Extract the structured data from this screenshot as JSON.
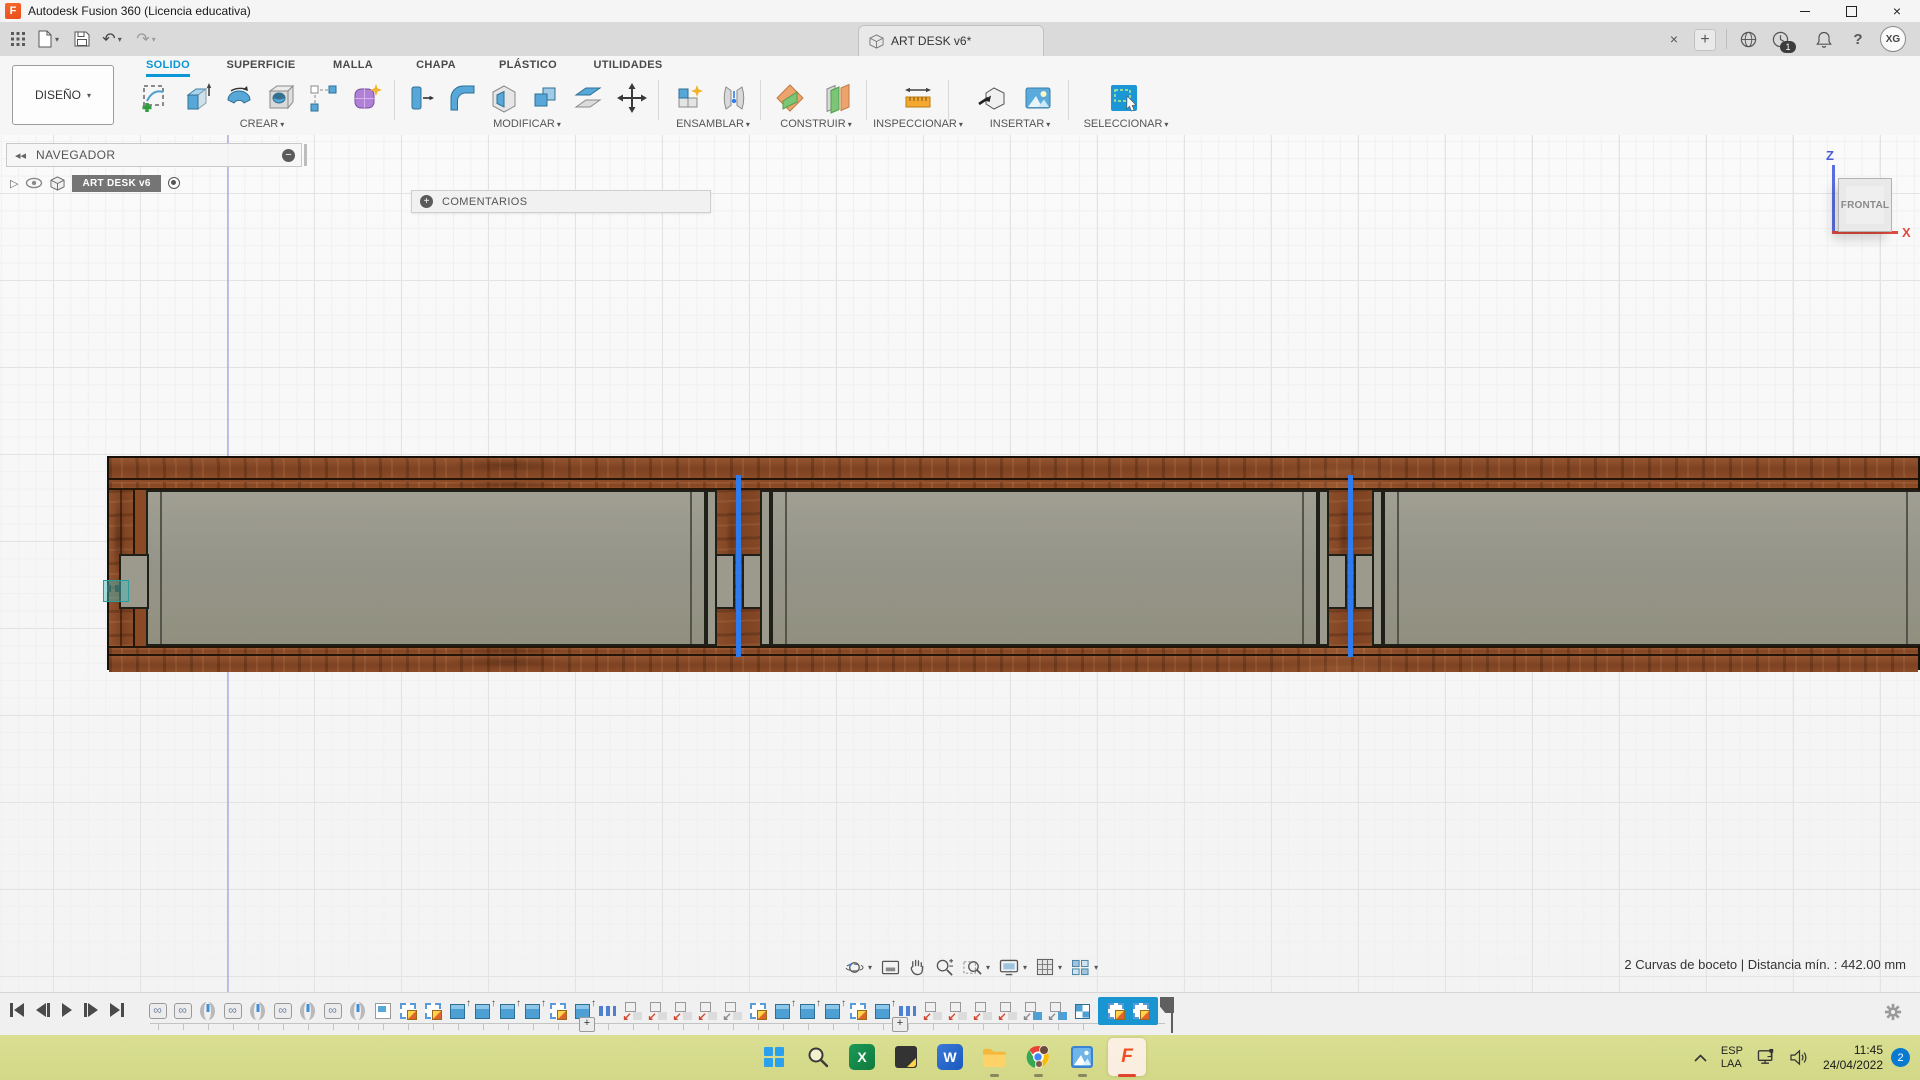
{
  "window": {
    "title": "Autodesk Fusion 360 (Licencia educativa)",
    "app_icon_letter": "F"
  },
  "doc_tab": {
    "label": "ART DESK v6*"
  },
  "top_right": {
    "close_tab": "×",
    "new_tab": "+",
    "jobs_badge": "1",
    "help": "?",
    "avatar": "XG"
  },
  "ribbon": {
    "design_button": "DISEÑO",
    "tabs": [
      {
        "label": "SOLIDO",
        "active": true
      },
      {
        "label": "SUPERFICIE"
      },
      {
        "label": "MALLA"
      },
      {
        "label": "CHAPA"
      },
      {
        "label": "PLÁSTICO"
      },
      {
        "label": "UTILIDADES"
      }
    ],
    "groups": [
      {
        "label": "CREAR"
      },
      {
        "label": "MODIFICAR"
      },
      {
        "label": "ENSAMBLAR"
      },
      {
        "label": "CONSTRUIR"
      },
      {
        "label": "INSPECCIONAR"
      },
      {
        "label": "INSERTAR"
      },
      {
        "label": "SELECCIONAR"
      }
    ]
  },
  "navigator": {
    "header": "NAVEGADOR",
    "item_label": "ART DESK v6"
  },
  "comments": {
    "label": "COMENTARIOS"
  },
  "viewcube": {
    "face": "FRONTAL",
    "axis_z": "Z",
    "axis_x": "X"
  },
  "status": {
    "selection": "2 Curvas de boceto | Distancia mín. : 442.00 mm"
  },
  "navbar_icons": [
    "orbit",
    "look-at",
    "pan",
    "zoom",
    "zoom-window",
    "display-settings",
    "grid-settings",
    "viewports"
  ],
  "timeline": {
    "features": [
      "rigid",
      "rigid",
      "joint",
      "rigid",
      "joint",
      "rigid",
      "joint",
      "rigid",
      "joint",
      "plane",
      "sketch",
      "sketch",
      "extrude",
      "extrude",
      "extrude",
      "extrude",
      "sketch",
      "extrude",
      "pattern",
      "move",
      "move",
      "move",
      "move",
      "movegray",
      "sketch",
      "extrude",
      "extrude",
      "extrude",
      "sketch",
      "extrude",
      "pattern",
      "move",
      "move",
      "move",
      "move",
      "moveblue",
      "moveblue",
      "combine"
    ],
    "selected_features": [
      "sketch",
      "sketch"
    ],
    "group_markers": [
      "+",
      "+"
    ]
  },
  "taskbar": {
    "apps": [
      "start",
      "search",
      "excel",
      "sticky-notes",
      "word",
      "file-explorer",
      "chrome",
      "photos",
      "fusion-360"
    ],
    "app_glyphs": {
      "excel": "X",
      "word": "W",
      "fusion": "F"
    },
    "tray": {
      "lang_top": "ESP",
      "lang_bottom": "LAA",
      "time": "11:45",
      "date": "24/04/2022",
      "notif_badge": "2"
    }
  },
  "colors": {
    "accent_blue": "#0a96d7",
    "selection_blue": "#2e7bf0",
    "timeline_highlight": "#1996d2",
    "wood_brown": "#8a4a26",
    "panel_gray": "#9b9a8c",
    "taskbar_green": "#d6dc8c",
    "axis_z_blue": "#5b6ede",
    "axis_x_red": "#e04b3f"
  }
}
